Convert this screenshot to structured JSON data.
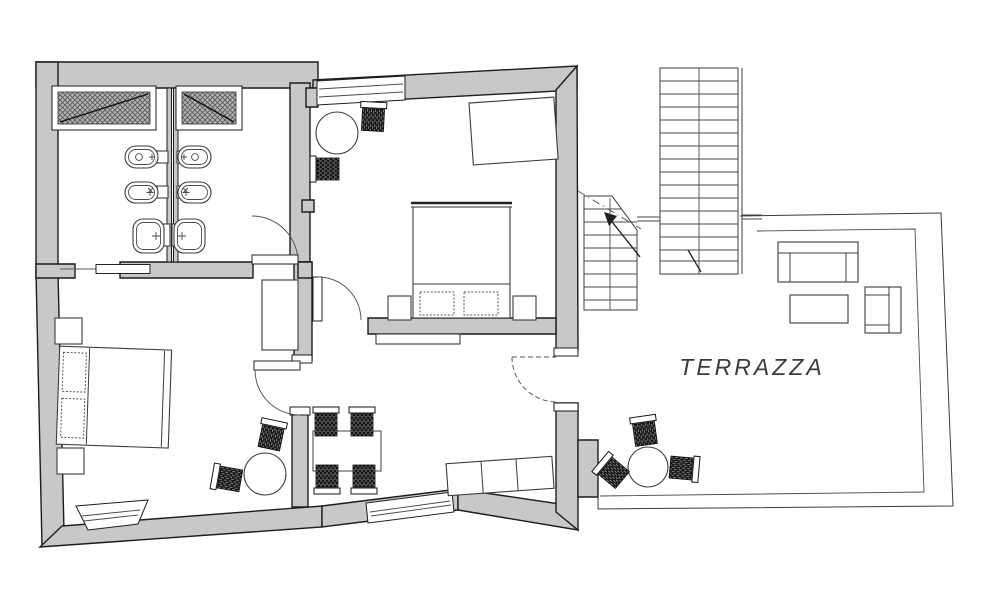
{
  "plan": {
    "labels": {
      "terrace": "TERRAZZA"
    },
    "rooms": [
      {
        "name": "bathroom-left",
        "fixtures": [
          "skylight-window",
          "toilet",
          "bidet",
          "washbasin"
        ]
      },
      {
        "name": "bathroom-right",
        "fixtures": [
          "skylight-window",
          "toilet",
          "bidet",
          "washbasin"
        ]
      },
      {
        "name": "bedroom-left",
        "furniture": [
          "double-bed",
          "nightstand",
          "nightstand",
          "round-table",
          "wicker-chair",
          "wicker-chair",
          "window"
        ]
      },
      {
        "name": "living-dining",
        "furniture": [
          "dining-table",
          "wicker-chair",
          "wicker-chair",
          "wicker-chair",
          "wicker-chair",
          "sideboard-bench",
          "wardrobe",
          "radiator",
          "window"
        ]
      },
      {
        "name": "bedroom-right",
        "furniture": [
          "double-bed",
          "nightstand",
          "nightstand",
          "tilted-wardrobe",
          "round-table",
          "wicker-chair",
          "wicker-chair",
          "window"
        ]
      },
      {
        "name": "stairwell",
        "features": [
          "small-staircase",
          "large-staircase",
          "up-arrow"
        ]
      },
      {
        "name": "terrace",
        "furniture": [
          "sofa",
          "coffee-table",
          "armchair",
          "round-table",
          "wicker-chair",
          "wicker-chair",
          "wicker-chair"
        ]
      }
    ]
  },
  "colors": {
    "wall": "#c8c8c8",
    "line": "#1c1c1c",
    "chair": "#141414",
    "paper": "#ffffff"
  }
}
